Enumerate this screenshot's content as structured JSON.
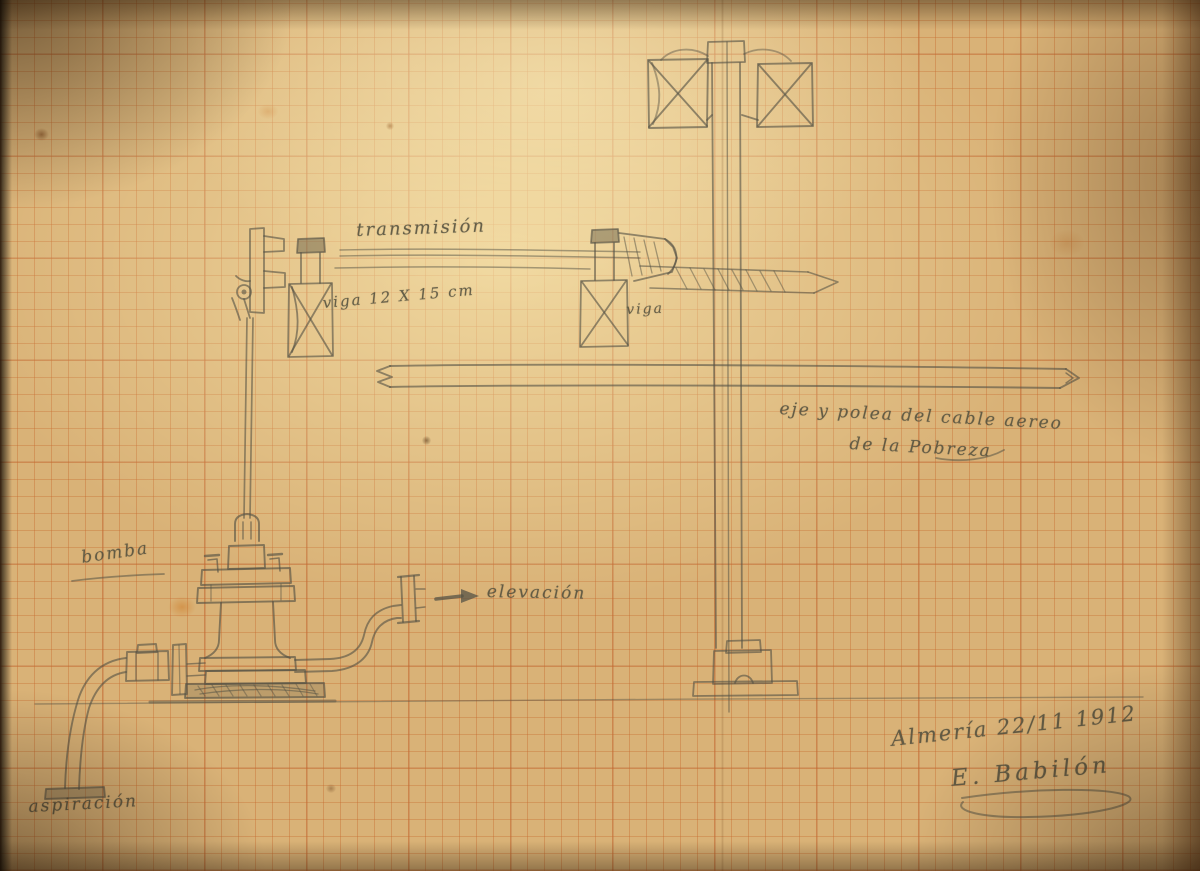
{
  "drawing": {
    "labels": {
      "transmission": "transmisión",
      "beam_dimension": "viga 12 X 15 cm",
      "beam": "viga",
      "cable_note_line1": "eje y polea del cable aereo",
      "cable_note_line2": "de la Pobreza",
      "pump": "bomba",
      "discharge": "elevación",
      "suction": "aspiración"
    },
    "footer": {
      "place_date": "Almería 22/11 1912",
      "signature": "E. Babilón"
    },
    "colors": {
      "paper": "#d9b277",
      "grid_line": "#c6692d",
      "pencil": "#565345"
    }
  }
}
